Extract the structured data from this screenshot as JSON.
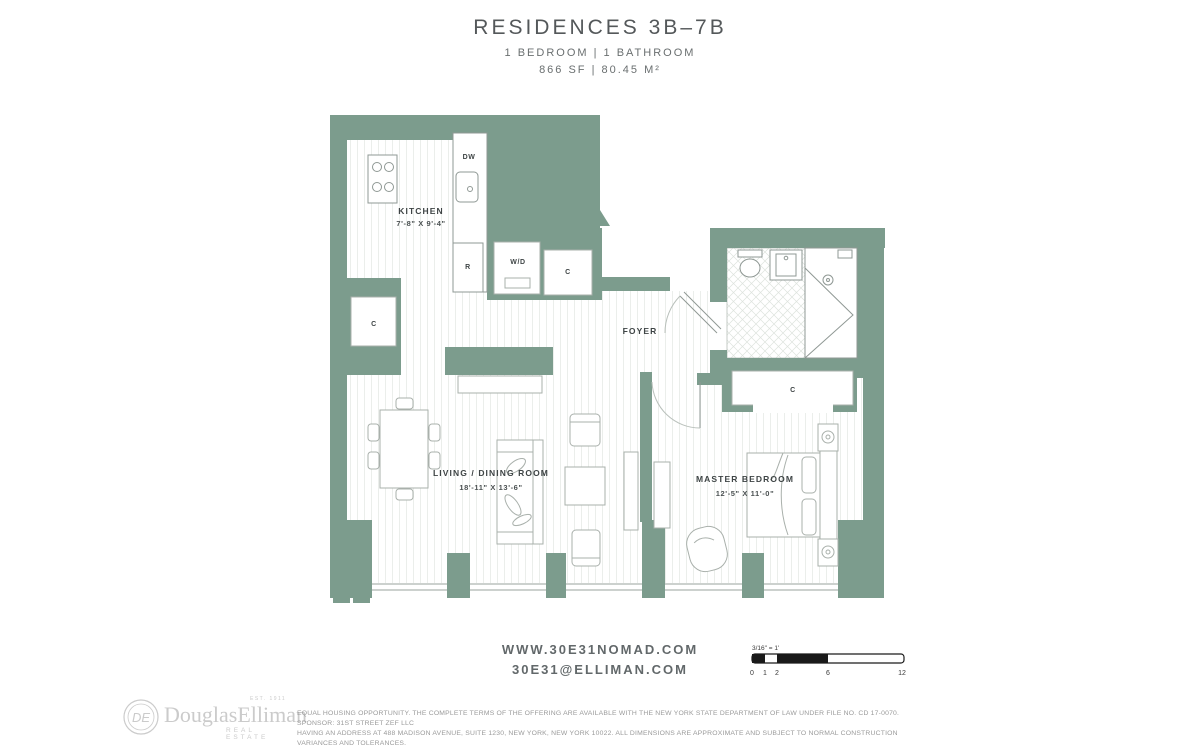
{
  "header": {
    "title": "RESIDENCES 3B–7B",
    "subtitle": "1 BEDROOM | 1 BATHROOM",
    "area": "866 SF | 80.45 M²"
  },
  "floorplan": {
    "rooms": {
      "kitchen": {
        "name": "KITCHEN",
        "dims": "7'-8\" X 9'-4\""
      },
      "foyer": {
        "name": "FOYER"
      },
      "living": {
        "name": "LIVING / DINING ROOM",
        "dims": "18'-11\" X 13'-6\""
      },
      "bedroom": {
        "name": "MASTER BEDROOM",
        "dims": "12'-5\" X 11'-0\""
      }
    },
    "appliances": {
      "dishwasher": "DW",
      "refrigerator": "R",
      "washer_dryer": "W/D",
      "closet": "C"
    },
    "colors": {
      "wall": "#7C9C8D",
      "furniture_line": "#A9B0AB",
      "label_text": "#3E4445"
    }
  },
  "scalebar": {
    "label": "3/16\" = 1'",
    "ticks": [
      "0",
      "1",
      "2",
      "6",
      "12"
    ]
  },
  "contact": {
    "website": "WWW.30E31NOMAD.COM",
    "email": "30E31@ELLIMAN.COM"
  },
  "brand": {
    "monogram": "DE",
    "name": "DouglasElliman",
    "est": "EST. 1911",
    "tagline": "REAL ESTATE"
  },
  "legal": {
    "line1": "EQUAL HOUSING OPPORTUNITY. THE COMPLETE TERMS OF THE OFFERING ARE AVAILABLE WITH THE NEW YORK STATE DEPARTMENT OF LAW UNDER FILE NO. CD 17-0070. SPONSOR: 31ST STREET ZEF LLC",
    "line2": "HAVING AN ADDRESS AT 488 MADISON AVENUE, SUITE 1230, NEW YORK, NEW YORK 10022. ALL DIMENSIONS ARE APPROXIMATE AND SUBJECT TO NORMAL CONSTRUCTION VARIANCES AND TOLERANCES."
  }
}
